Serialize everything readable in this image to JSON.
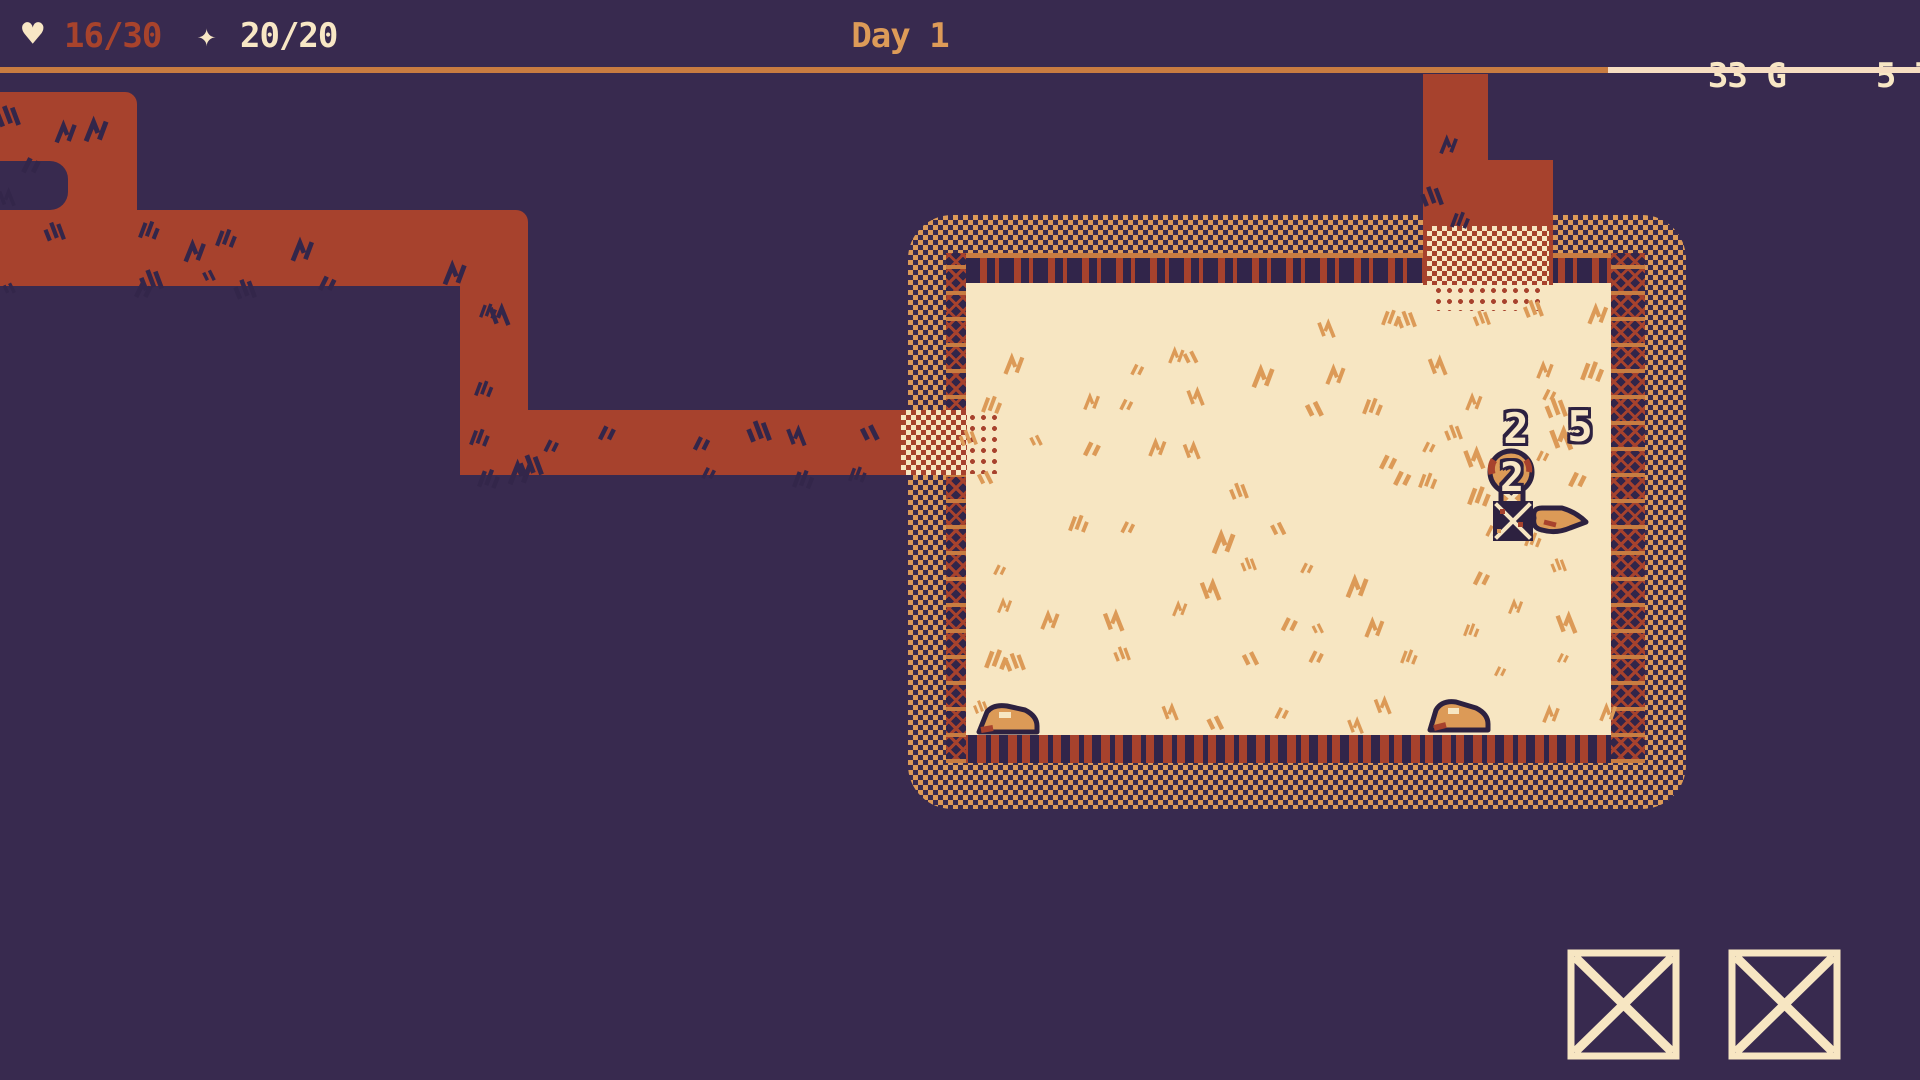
{
  "hud": {
    "health": {
      "icon_name": "heart-icon",
      "icon_char": "♥",
      "value": "16/30"
    },
    "spirit": {
      "icon_name": "sparkle-icon",
      "icon_char": "✦",
      "value": "20/20"
    },
    "day_label": "Day 1",
    "gold": {
      "value": "33",
      "unit": "G"
    },
    "tp": {
      "value": "5",
      "unit": "TP"
    }
  },
  "map": {
    "floating_numbers": {
      "left": "2",
      "right": "5"
    },
    "enemy": {
      "name": "enemy-creature",
      "power": "2"
    },
    "marker_tile": "x-marked-tile",
    "ground_item": "feather",
    "props": [
      "rock",
      "rock"
    ]
  },
  "slots": {
    "count": 2,
    "slot_icon": "x-icon"
  },
  "colors": {
    "background": "#382a4f",
    "corridor_red": "#a7422d",
    "accent_orange": "#dc9a57",
    "underline_orange": "#c87c41",
    "cream": "#f7e6c2",
    "hud_cream": "#f8e7c5",
    "hp_red": "#a8432c",
    "day_orange": "#dd9b58",
    "outline_dark": "#2d2140"
  }
}
